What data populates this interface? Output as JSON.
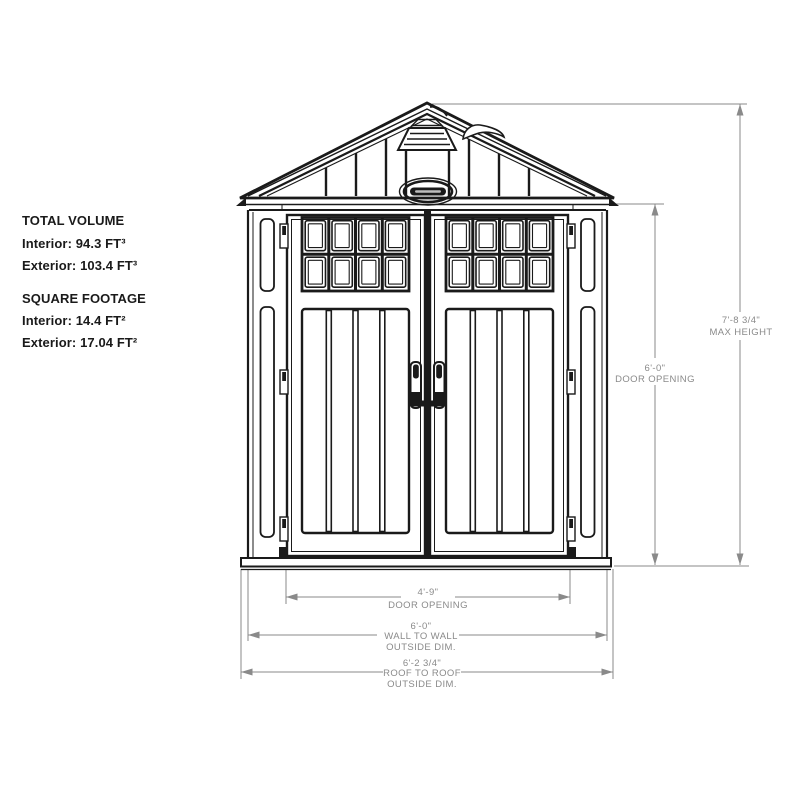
{
  "specs": {
    "volume": {
      "heading": "TOTAL VOLUME",
      "interior": "Interior: 94.3 FT³",
      "exterior": "Exterior: 103.4 FT³"
    },
    "footage": {
      "heading": "SQUARE FOOTAGE",
      "interior": "Interior: 14.4 FT²",
      "exterior": "Exterior: 17.04 FT²"
    }
  },
  "dimensions": {
    "max_height": {
      "value": "7'-8 3/4\"",
      "label": "MAX HEIGHT"
    },
    "door_height": {
      "value": "6'-0\"",
      "label": "DOOR OPENING"
    },
    "door_width": {
      "value": "4'-9\"",
      "label": "DOOR OPENING"
    },
    "wall_width": {
      "value": "6'-0\"",
      "label_line1": "WALL TO WALL",
      "label_line2": "OUTSIDE DIM."
    },
    "roof_width": {
      "value": "6'-2 3/4\"",
      "label_line1": "ROOF TO ROOF",
      "label_line2": "OUTSIDE DIM."
    }
  },
  "colors": {
    "line": "#1a1a1a",
    "dim": "#8a8a8a",
    "background": "#ffffff"
  }
}
